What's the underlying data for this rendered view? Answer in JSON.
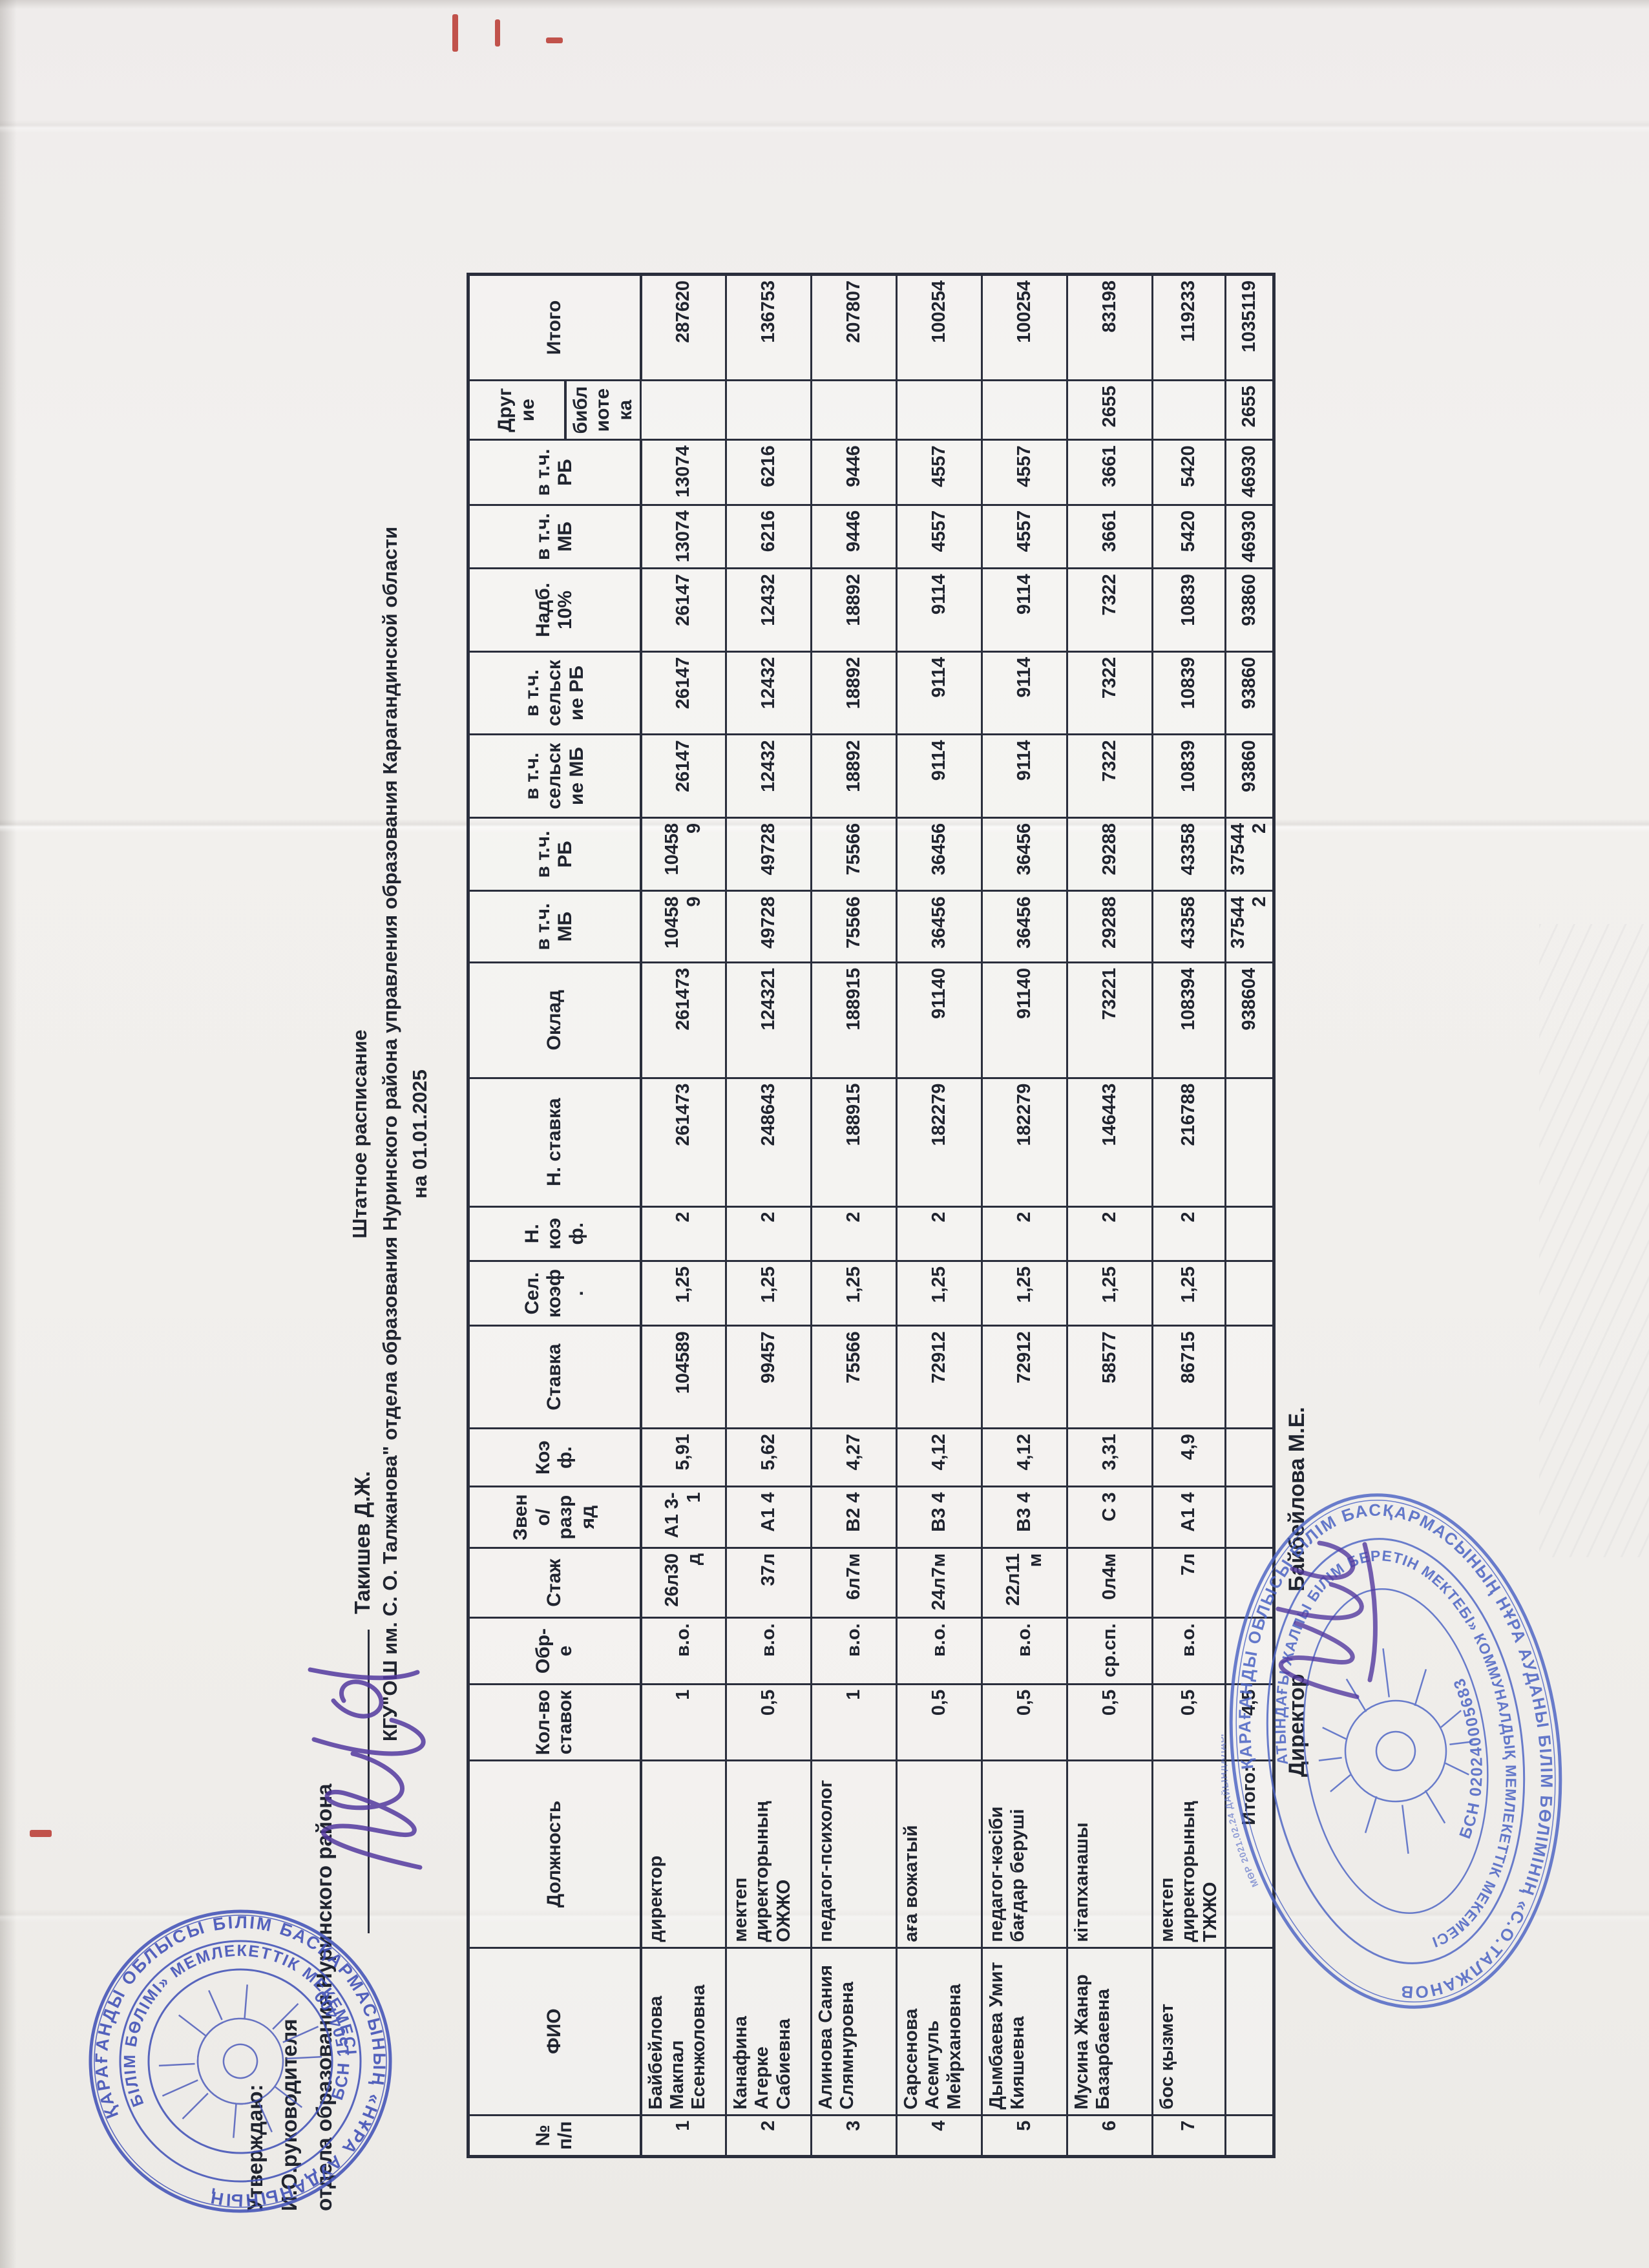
{
  "document": {
    "approval": {
      "line1": "Утверждаю:",
      "line2": "И.О.руководителя",
      "line3": "отдела образования Нуринского района",
      "signatory": "Такишев Д.Ж."
    },
    "title": {
      "line1": "Штатное расписание",
      "line2": "КГУ\"ОШ им. С. О. Талжанова\" отдела образования Нуринского района управления образования Карагандинской области",
      "line3": "на 01.01.2025"
    },
    "footer": {
      "label": "Директор",
      "name": "Байбейлова М.Е."
    }
  },
  "table": {
    "headers": [
      "№ п/п",
      "ФИО",
      "Должность",
      "Кол-во ставок",
      "Обр-е",
      "Стаж",
      "Звено/ разряд",
      "Коэф.",
      "Ставка",
      "Сел. коэф.",
      "Н. коэф.",
      "Н. ставка",
      "Оклад",
      "в т.ч. МБ",
      "в т.ч. РБ",
      "в т.ч. сельские МБ",
      "в т.ч. сельские РБ",
      "Надб. 10%",
      "в т.ч. МБ",
      "в т.ч. РБ",
      "Другие",
      "Итого"
    ],
    "sub_header": "библиотека",
    "rows": [
      [
        "1",
        "Байбейлова Макпал Есенжоловна",
        "директор",
        "1",
        "в.о.",
        "26л30д",
        "А1 3-1",
        "5,91",
        "104589",
        "1,25",
        "2",
        "261473",
        "261473",
        "104589",
        "104589",
        "26147",
        "26147",
        "26147",
        "13074",
        "13074",
        "",
        "287620"
      ],
      [
        "2",
        "Канафина Агерке Сабиевна",
        "мектеп директорының ОЖЖО",
        "0,5",
        "в.о.",
        "37л",
        "А1 4",
        "5,62",
        "99457",
        "1,25",
        "2",
        "248643",
        "124321",
        "49728",
        "49728",
        "12432",
        "12432",
        "12432",
        "6216",
        "6216",
        "",
        "136753"
      ],
      [
        "3",
        "Алинова Сания Слямнуровна",
        "педагог-психолог",
        "1",
        "в.о.",
        "6л7м",
        "В2 4",
        "4,27",
        "75566",
        "1,25",
        "2",
        "188915",
        "188915",
        "75566",
        "75566",
        "18892",
        "18892",
        "18892",
        "9446",
        "9446",
        "",
        "207807"
      ],
      [
        "4",
        "Сарсенова Асемгуль Мейрхановна",
        "аға вожатый",
        "0,5",
        "в.о.",
        "24л7м",
        "В3 4",
        "4,12",
        "72912",
        "1,25",
        "2",
        "182279",
        "91140",
        "36456",
        "36456",
        "9114",
        "9114",
        "9114",
        "4557",
        "4557",
        "",
        "100254"
      ],
      [
        "5",
        "Дымбаева Умит Кияшевна",
        "педагог-кәсіби бағдар беруші",
        "0,5",
        "в.о.",
        "22л11м",
        "В3 4",
        "4,12",
        "72912",
        "1,25",
        "2",
        "182279",
        "91140",
        "36456",
        "36456",
        "9114",
        "9114",
        "9114",
        "4557",
        "4557",
        "",
        "100254"
      ],
      [
        "6",
        "Мусина Жанар Базарбаевна",
        "кітапханашы",
        "0,5",
        "ср.сп.",
        "0л4м",
        "С 3",
        "3,31",
        "58577",
        "1,25",
        "2",
        "146443",
        "73221",
        "29288",
        "29288",
        "7322",
        "7322",
        "7322",
        "3661",
        "3661",
        "2655",
        "83198"
      ],
      [
        "7",
        "бос қызмет",
        "мектеп директорының ТЖЖО",
        "0,5",
        "в.о.",
        "7л",
        "А1 4",
        "4,9",
        "86715",
        "1,25",
        "2",
        "216788",
        "108394",
        "43358",
        "43358",
        "10839",
        "10839",
        "10839",
        "5420",
        "5420",
        "",
        "119233"
      ],
      [
        "",
        "",
        "Итого:",
        "4,5",
        "",
        "",
        "",
        "",
        "",
        "",
        "",
        "",
        "938604",
        "375442",
        "375442",
        "93860",
        "93860",
        "93860",
        "46930",
        "46930",
        "2655",
        "1035119"
      ]
    ]
  },
  "stamps": {
    "district": {
      "outer_text": "ҚАРАҒАНДЫ ОБЛЫСЫ БІЛІМ БАСҚАРМАСЫНЫҢ «НҰРА АУДАНЫНЫҢ",
      "inner_text": "БІЛІМ БӨЛІМІ» МЕМЛЕКЕТТІК МЕКЕМЕСІ",
      "bsn": "БСН 1504400"
    },
    "school": {
      "outer_text": "ҚАРАҒАНДЫ ОБЛЫСЫ БІЛІМ БАСҚАРМАСЫНЫҢ НҰРА АУДАНЫ БІЛІМ БӨЛІМІНІҢ «С.О.ТАЛЖАНОВ",
      "inner_text": "АТЫНДАҒЫ ЖАЛПЫ БІЛІМ БЕРЕТІН МЕКТЕБІ» КОММУНАЛДЫҚ МЕМЛЕКЕТТІК МЕКЕМЕСІ",
      "bsn": "БСН 020240005683",
      "micro": "МӨР 2021.02.24 ДАЙЫНДАЛДЫ"
    }
  }
}
